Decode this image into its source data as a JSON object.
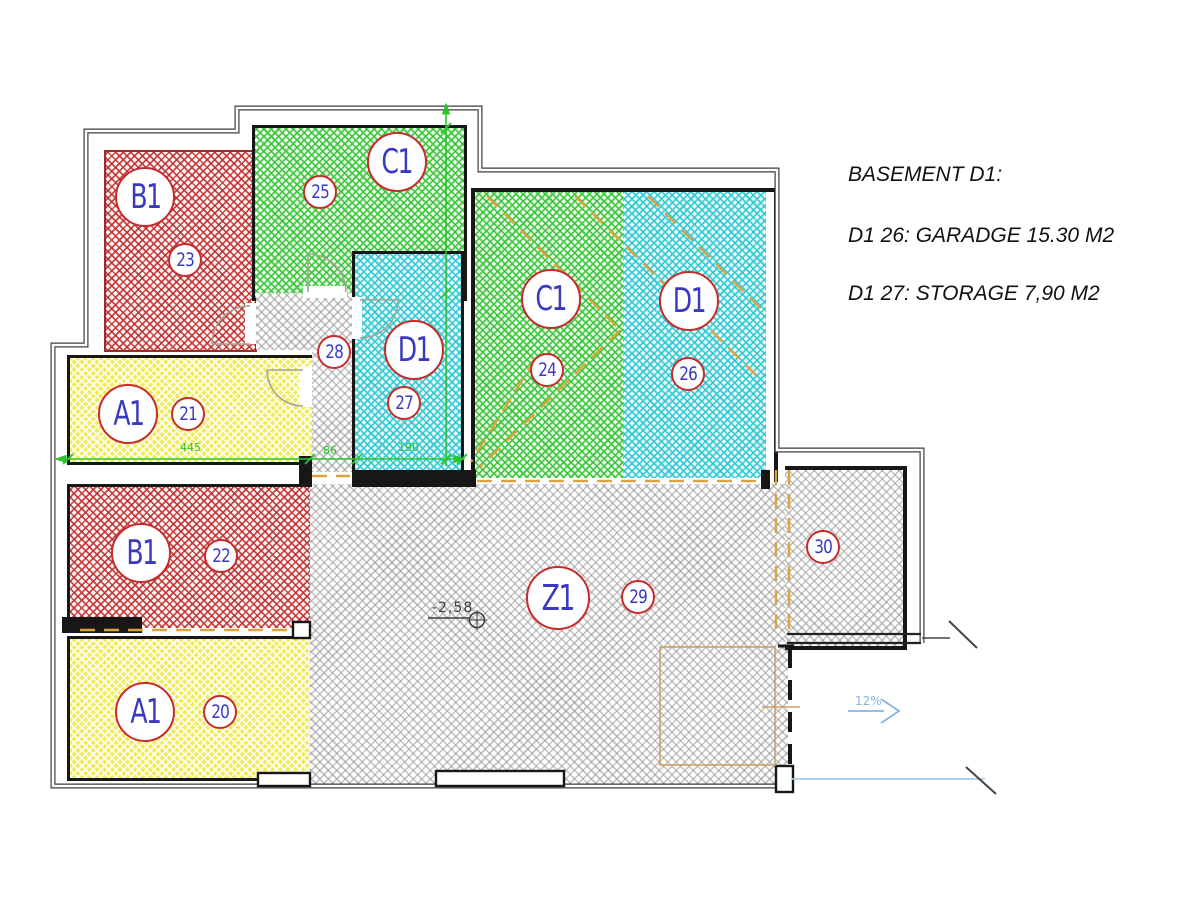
{
  "annotation_panel": {
    "line1": "BASEMENT D1:",
    "line2": "D1 26: GARADGE 15.30 M2",
    "line3": "D1 27: STORAGE 7,90 M2"
  },
  "rooms": {
    "r23": {
      "label": "B1",
      "number": "23"
    },
    "r25": {
      "label": "C1",
      "number": "25"
    },
    "r27": {
      "label": "D1",
      "number": "27"
    },
    "r24": {
      "label": "C1",
      "number": "24"
    },
    "r26": {
      "label": "D1",
      "number": "26"
    },
    "r21": {
      "label": "A1",
      "number": "21"
    },
    "r22": {
      "label": "B1",
      "number": "22"
    },
    "r20": {
      "label": "A1",
      "number": "20"
    },
    "z1": {
      "label": "Z1",
      "number": "29"
    },
    "hall": {
      "number": "28"
    },
    "r30": {
      "number": "30"
    }
  },
  "dimensions": {
    "d1": "445",
    "d2": "86",
    "d3": "190"
  },
  "markers": {
    "elevation": "-2,58",
    "ramp_slope": "12%"
  },
  "colors": {
    "hatch_red": "#c02a2a",
    "hatch_green": "#3ac63a",
    "hatch_cyan": "#30c8d4",
    "hatch_yellow": "#f2ec5c",
    "hatch_gray": "#919191",
    "label_blue": "#3939c2",
    "circle_red": "#c62c2c",
    "dimension_green": "#2bc42b",
    "parking_orange": "#dfa23f",
    "ramp_blue": "#85b4e2"
  }
}
